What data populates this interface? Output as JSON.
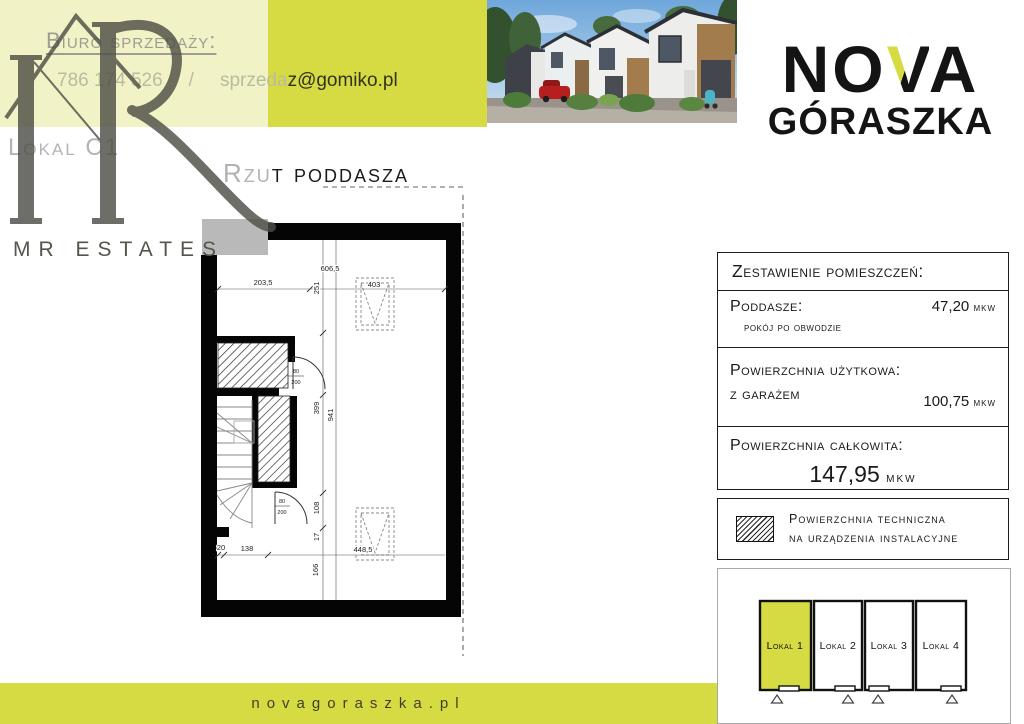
{
  "colors": {
    "accent_bright": "#d6db44",
    "accent_pale": "#f1f3c6",
    "watermark_gray": "#4f4f47",
    "wall_black": "#050505"
  },
  "contact": {
    "heading": "Biuro sprzedaży:",
    "phone": "786 174 526",
    "separator": "/",
    "email_prefix": "sprzeda",
    "email_suffix": "z@gomiko.pl"
  },
  "unit": {
    "label": "Lokal C1"
  },
  "watermark": {
    "brand": "MR ESTATES"
  },
  "title": {
    "part_light": "Rzu",
    "part_dark": "t poddasza"
  },
  "brand": {
    "part1": "NO",
    "part2": "V",
    "part3": "A",
    "line2": "GÓRASZKA"
  },
  "plan": {
    "dims": {
      "width_total": "606,5",
      "width_left": "203,5",
      "width_mid": "251",
      "window_top": "403",
      "height_upper": "399",
      "height_total": "941",
      "height_mid": "108",
      "height_small": "17",
      "height_lower": "166",
      "bottom_left": "20",
      "bottom_seg": "138",
      "window_bottom": "448,5"
    },
    "door": {
      "width": "80",
      "height": "200"
    }
  },
  "summary": {
    "header": "Zestawienie pomieszczeń:",
    "rows": [
      {
        "label": "Poddasze:",
        "sublabel": "pokój po obwodzie",
        "value": "47,20",
        "unit": "mkw"
      },
      {
        "label": "Powierzchnia użytkowa:",
        "sublabel": "z garażem",
        "value": "100,75",
        "unit": "mkw"
      },
      {
        "label": "Powierzchnia całkowita:",
        "value": "147,95",
        "unit": "mkw"
      }
    ]
  },
  "legend": {
    "line1": "Powierzchnia techniczna",
    "line2": "na urządzenia instalacyjne"
  },
  "minimap": {
    "highlighted": "Lokal 1",
    "units": [
      {
        "label": "Lokal 1"
      },
      {
        "label": "Lokal 2"
      },
      {
        "label": "Lokal 3"
      },
      {
        "label": "Lokal 4"
      }
    ]
  },
  "footer": {
    "url": "novagoraszka.pl"
  }
}
